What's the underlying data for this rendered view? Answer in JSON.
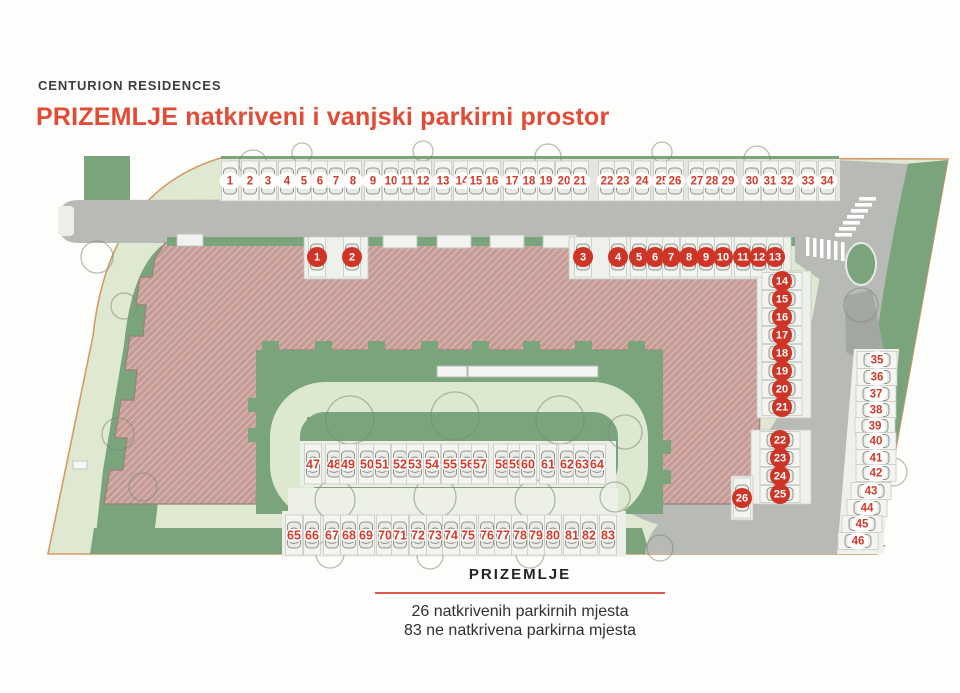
{
  "header": {
    "brand": "CENTURION RESIDENCES",
    "title": "PRIZEMLJE natkriveni i vanjski parkirni prostor"
  },
  "legend": {
    "title": "PRIZEMLJE",
    "covered_line": "26 natkrivenih parkirnih mjesta",
    "outdoor_line": "83 ne natkrivena parkirna mjesta"
  },
  "colors": {
    "accent_red": "#cf3527",
    "number_red": "#d23b2a",
    "title_red": "#e14b38",
    "divider_red": "#e2574e",
    "green_dark": "#7aa47c",
    "green_pale": "#dfe9d1",
    "road_gray": "#b8bab6",
    "building_rose": "#c69b95",
    "boundary_orange": "#d69a63"
  },
  "parking": {
    "groups": [
      {
        "id": "outdoor-top-row",
        "type": "outdoor",
        "badge": "ellipse",
        "orient": "v",
        "spots": [
          {
            "n": 1,
            "x": 230,
            "y": 181
          },
          {
            "n": 2,
            "x": 250,
            "y": 181
          },
          {
            "n": 3,
            "x": 268,
            "y": 181
          },
          {
            "n": 4,
            "x": 287,
            "y": 181
          },
          {
            "n": 5,
            "x": 304,
            "y": 181
          },
          {
            "n": 6,
            "x": 320,
            "y": 181
          },
          {
            "n": 7,
            "x": 336,
            "y": 181
          },
          {
            "n": 8,
            "x": 353,
            "y": 181
          },
          {
            "n": 9,
            "x": 373,
            "y": 181
          },
          {
            "n": 10,
            "x": 391,
            "y": 181
          },
          {
            "n": 11,
            "x": 407,
            "y": 181
          },
          {
            "n": 12,
            "x": 423,
            "y": 181
          },
          {
            "n": 13,
            "x": 443,
            "y": 181
          },
          {
            "n": 14,
            "x": 462,
            "y": 181
          },
          {
            "n": 15,
            "x": 476,
            "y": 181
          },
          {
            "n": 16,
            "x": 492,
            "y": 181
          },
          {
            "n": 17,
            "x": 512,
            "y": 181
          },
          {
            "n": 18,
            "x": 529,
            "y": 181
          },
          {
            "n": 19,
            "x": 546,
            "y": 181
          },
          {
            "n": 20,
            "x": 564,
            "y": 181
          },
          {
            "n": 21,
            "x": 580,
            "y": 181
          },
          {
            "n": 22,
            "x": 607,
            "y": 181
          },
          {
            "n": 23,
            "x": 623,
            "y": 181
          },
          {
            "n": 24,
            "x": 642,
            "y": 181
          },
          {
            "n": 25,
            "x": 662,
            "y": 181
          },
          {
            "n": 26,
            "x": 675,
            "y": 181
          },
          {
            "n": 27,
            "x": 697,
            "y": 181
          },
          {
            "n": 28,
            "x": 712,
            "y": 181
          },
          {
            "n": 29,
            "x": 728,
            "y": 181
          },
          {
            "n": 30,
            "x": 752,
            "y": 181
          },
          {
            "n": 31,
            "x": 770,
            "y": 181
          },
          {
            "n": 32,
            "x": 787,
            "y": 181
          },
          {
            "n": 33,
            "x": 808,
            "y": 181
          },
          {
            "n": 34,
            "x": 827,
            "y": 181
          }
        ]
      },
      {
        "id": "covered-row",
        "type": "covered",
        "orient": "v",
        "spots": [
          {
            "n": 1,
            "x": 317,
            "y": 257
          },
          {
            "n": 2,
            "x": 352,
            "y": 257
          },
          {
            "n": 3,
            "x": 583,
            "y": 257
          },
          {
            "n": 4,
            "x": 618,
            "y": 257
          },
          {
            "n": 5,
            "x": 639,
            "y": 257
          },
          {
            "n": 6,
            "x": 655,
            "y": 257
          },
          {
            "n": 7,
            "x": 671,
            "y": 257
          },
          {
            "n": 8,
            "x": 689,
            "y": 257
          },
          {
            "n": 9,
            "x": 706,
            "y": 257
          },
          {
            "n": 10,
            "x": 723,
            "y": 257
          },
          {
            "n": 11,
            "x": 743,
            "y": 257
          },
          {
            "n": 12,
            "x": 759,
            "y": 257
          },
          {
            "n": 13,
            "x": 775,
            "y": 257
          }
        ]
      },
      {
        "id": "covered-right-upper",
        "type": "covered",
        "orient": "h",
        "spots": [
          {
            "n": 14,
            "x": 782,
            "y": 281
          },
          {
            "n": 15,
            "x": 782,
            "y": 299
          },
          {
            "n": 16,
            "x": 782,
            "y": 317
          },
          {
            "n": 17,
            "x": 782,
            "y": 335
          },
          {
            "n": 18,
            "x": 782,
            "y": 353
          },
          {
            "n": 19,
            "x": 782,
            "y": 371
          },
          {
            "n": 20,
            "x": 782,
            "y": 389
          },
          {
            "n": 21,
            "x": 782,
            "y": 407
          }
        ]
      },
      {
        "id": "covered-right-lower",
        "type": "covered",
        "orient": "h",
        "spots": [
          {
            "n": 22,
            "x": 780,
            "y": 440
          },
          {
            "n": 23,
            "x": 780,
            "y": 458
          },
          {
            "n": 24,
            "x": 780,
            "y": 476
          },
          {
            "n": 25,
            "x": 780,
            "y": 494
          }
        ]
      },
      {
        "id": "covered-single",
        "type": "covered",
        "orient": "v",
        "spots": [
          {
            "n": 26,
            "x": 742,
            "y": 498
          }
        ]
      },
      {
        "id": "outdoor-right-column",
        "type": "outdoor",
        "badge": "ellipse",
        "orient": "h",
        "spots": [
          {
            "n": 35,
            "x": 877,
            "y": 360
          },
          {
            "n": 36,
            "x": 877,
            "y": 377
          },
          {
            "n": 37,
            "x": 876,
            "y": 394
          },
          {
            "n": 38,
            "x": 876,
            "y": 410
          },
          {
            "n": 39,
            "x": 875,
            "y": 426
          },
          {
            "n": 40,
            "x": 876,
            "y": 441
          },
          {
            "n": 41,
            "x": 876,
            "y": 458
          },
          {
            "n": 42,
            "x": 876,
            "y": 473
          },
          {
            "n": 43,
            "x": 871,
            "y": 491
          },
          {
            "n": 44,
            "x": 867,
            "y": 508
          },
          {
            "n": 45,
            "x": 862,
            "y": 524
          },
          {
            "n": 46,
            "x": 858,
            "y": 541
          }
        ]
      },
      {
        "id": "outdoor-mid-row",
        "type": "outdoor",
        "badge": "halo",
        "orient": "v",
        "spots": [
          {
            "n": 47,
            "x": 313,
            "y": 464
          },
          {
            "n": 48,
            "x": 334,
            "y": 464
          },
          {
            "n": 49,
            "x": 348,
            "y": 464
          },
          {
            "n": 50,
            "x": 367,
            "y": 464
          },
          {
            "n": 51,
            "x": 382,
            "y": 464
          },
          {
            "n": 52,
            "x": 400,
            "y": 464
          },
          {
            "n": 53,
            "x": 415,
            "y": 464
          },
          {
            "n": 54,
            "x": 432,
            "y": 464
          },
          {
            "n": 55,
            "x": 450,
            "y": 464
          },
          {
            "n": 56,
            "x": 467,
            "y": 464
          },
          {
            "n": 57,
            "x": 480,
            "y": 464
          },
          {
            "n": 58,
            "x": 502,
            "y": 464
          },
          {
            "n": 59,
            "x": 516,
            "y": 464
          },
          {
            "n": 60,
            "x": 528,
            "y": 464
          },
          {
            "n": 61,
            "x": 548,
            "y": 464
          },
          {
            "n": 62,
            "x": 567,
            "y": 464
          },
          {
            "n": 63,
            "x": 582,
            "y": 464
          },
          {
            "n": 64,
            "x": 597,
            "y": 464
          }
        ]
      },
      {
        "id": "outdoor-bottom-row",
        "type": "outdoor",
        "badge": "halo",
        "orient": "v",
        "spots": [
          {
            "n": 65,
            "x": 294,
            "y": 535
          },
          {
            "n": 66,
            "x": 312,
            "y": 535
          },
          {
            "n": 67,
            "x": 332,
            "y": 535
          },
          {
            "n": 68,
            "x": 349,
            "y": 535
          },
          {
            "n": 69,
            "x": 366,
            "y": 535
          },
          {
            "n": 70,
            "x": 385,
            "y": 535
          },
          {
            "n": 71,
            "x": 400,
            "y": 535
          },
          {
            "n": 72,
            "x": 418,
            "y": 535
          },
          {
            "n": 73,
            "x": 435,
            "y": 535
          },
          {
            "n": 74,
            "x": 451,
            "y": 535
          },
          {
            "n": 75,
            "x": 468,
            "y": 535
          },
          {
            "n": 76,
            "x": 487,
            "y": 535
          },
          {
            "n": 77,
            "x": 503,
            "y": 535
          },
          {
            "n": 78,
            "x": 520,
            "y": 535
          },
          {
            "n": 79,
            "x": 536,
            "y": 535
          },
          {
            "n": 80,
            "x": 553,
            "y": 535
          },
          {
            "n": 81,
            "x": 572,
            "y": 535
          },
          {
            "n": 82,
            "x": 589,
            "y": 535
          },
          {
            "n": 83,
            "x": 608,
            "y": 535
          }
        ]
      }
    ]
  }
}
